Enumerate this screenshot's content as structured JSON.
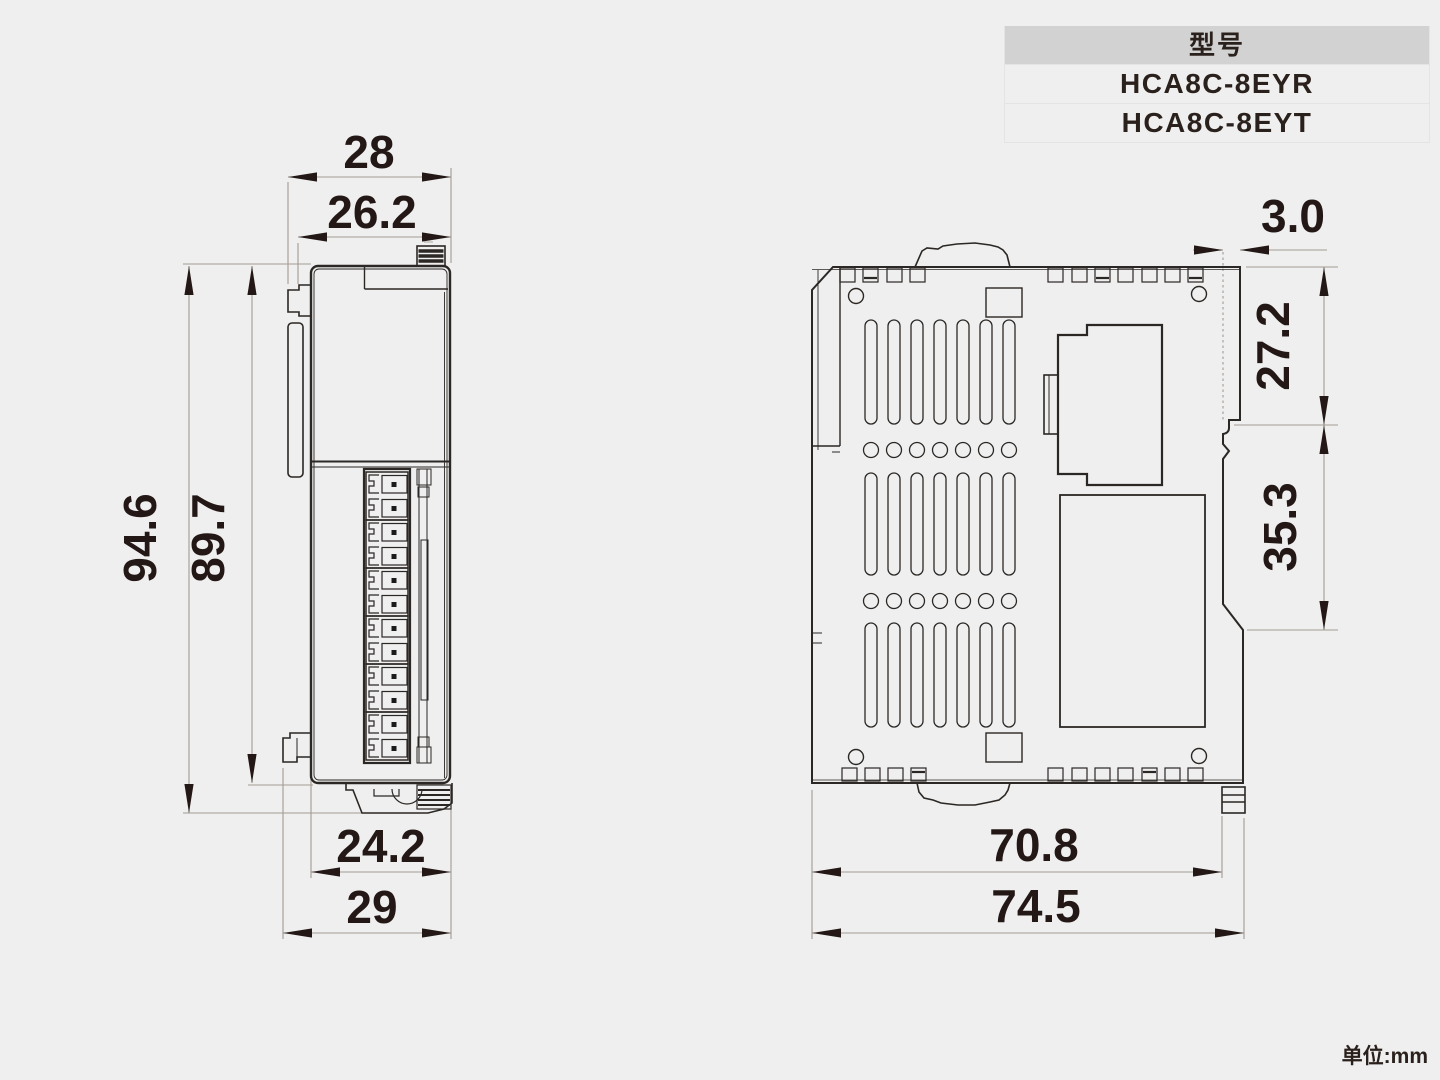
{
  "page": {
    "unit_note": "单位:mm",
    "background": "#efefef"
  },
  "model_table": {
    "header": "型号",
    "models": [
      "HCA8C-8EYR",
      "HCA8C-8EYT"
    ]
  },
  "front_view": {
    "dimensions": {
      "width_overall": "28",
      "width_body": "26.2",
      "height_overall": "94.6",
      "height_body": "89.7",
      "depth_bottom_inner": "24.2",
      "depth_bottom_overall": "29"
    }
  },
  "side_view": {
    "dimensions": {
      "rail_offset": "3.0",
      "upper_depth": "27.2",
      "lower_depth": "35.3",
      "width_inner": "70.8",
      "width_overall": "74.5"
    }
  },
  "colors": {
    "outline": "#2b2724",
    "dim_line": "#a39b93",
    "dim_text": "#231815",
    "table_header_bg": "#d2d2d3"
  }
}
